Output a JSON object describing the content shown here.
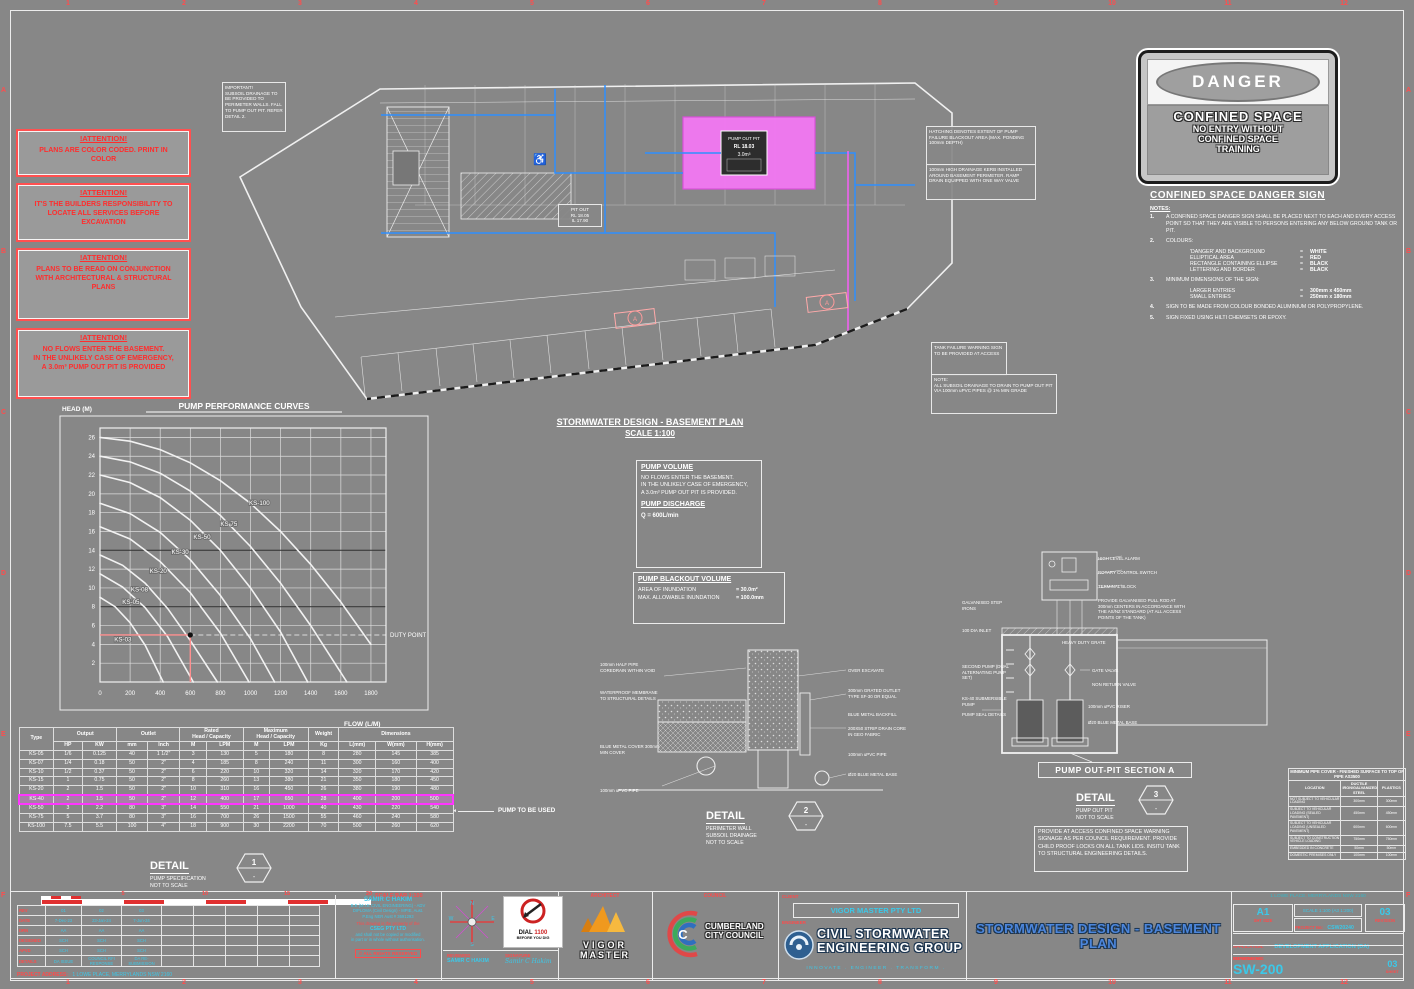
{
  "margin": {
    "cols": [
      "1",
      "2",
      "3",
      "4",
      "5",
      "6",
      "7",
      "8",
      "9",
      "10",
      "11",
      "12"
    ],
    "rows": [
      "A",
      "B",
      "C",
      "D",
      "E",
      "F"
    ]
  },
  "attention": [
    {
      "title": "!ATTENTION!",
      "body": "PLANS ARE COLOR CODED. PRINT IN\nCOLOR"
    },
    {
      "title": "!ATTENTION!",
      "body": "IT'S THE BUILDERS RESPONSIBILITY TO\nLOCATE ALL SERVICES BEFORE\nEXCAVATION"
    },
    {
      "title": "!ATTENTION!",
      "body": "PLANS TO BE READ ON CONJUNCTION\nWITH ARCHITECTURAL & STRUCTURAL\nPLANS"
    },
    {
      "title": "!ATTENTION!",
      "body": "NO FLOWS ENTER THE BASEMENT.\nIN THE UNLIKELY CASE OF EMERGENCY,\nA 3.0m³ PUMP OUT PIT IS PROVIDED"
    }
  ],
  "plan": {
    "title": "STORMWATER DESIGN - BASEMENT PLAN",
    "scale": "SCALE 1:100",
    "pit_l1": "PUMP OUT PIT",
    "pit_l2": "RL 18.03",
    "pit_l3": "3.0m³",
    "pit_out": "PIT OUT\nRL 18.05\nIL 17.90",
    "section_marker": "A",
    "notes": [
      "IMPORTANT!\nSUBSOIL DRAINAGE TO BE PROVIDED TO PERIMETER WALLS. FALL TO PUMP OUT PIT. REFER DETAIL 2.",
      "HATCHING DENOTES EXTENT OF PUMP FAILURE BLACKOUT AREA (MAX. PONDING 100mm DEPTH)",
      "100mm HIGH DRAINAGE KERB INSTALLED AROUND BASEMENT PERIMETER. RAMP DRAIN EQUIPPED WITH ONE WAY VALVE",
      "TANK FAILURE WARNING SIGN TO BE PROVIDED AT ACCESS",
      "NOTE:\nALL SUBSOIL DRAINAGE TO DRAIN TO PUMP OUT PIT VIA 100mm uPVC PIPES @ 1% MIN GRADE"
    ]
  },
  "danger_sign": {
    "word": "DANGER",
    "line1": "CONFINED SPACE",
    "line2": "NO ENTRY WITHOUT",
    "line3": "CONFINED SPACE",
    "line4": "TRAINING"
  },
  "confined": {
    "heading": "CONFINED SPACE DANGER SIGN",
    "notes_label": "NOTES:",
    "items": [
      {
        "n": "1.",
        "text": "A CONFINED SPACE DANGER SIGN SHALL BE PLACED NEXT TO EACH AND EVERY ACCESS POINT SO THAT THEY ARE VISIBLE TO PERSONS ENTERING ANY BELOW GROUND TANK OR PIT."
      },
      {
        "n": "2.",
        "text": "COLOURS:",
        "pairs": [
          [
            "'DANGER' AND BACKGROUND",
            "WHITE"
          ],
          [
            "ELLIPTICAL AREA",
            "RED"
          ],
          [
            "RECTANGLE CONTAINING ELLIPSE",
            "BLACK"
          ],
          [
            "LETTERING AND BORDER",
            "BLACK"
          ]
        ]
      },
      {
        "n": "3.",
        "text": "MINIMUM DIMENSIONS OF THE SIGN:",
        "pairs": [
          [
            "LARGER ENTRIES",
            "300mm x 450mm"
          ],
          [
            "SMALL ENTRIES",
            "250mm x 180mm"
          ]
        ]
      },
      {
        "n": "4.",
        "text": "SIGN TO BE MADE FROM COLOUR BONDED ALUMINIUM OR POLYPROPYLENE."
      },
      {
        "n": "5.",
        "text": "SIGN FIXED USING HILTI CHEMSETS OR EPOXY."
      }
    ]
  },
  "chart_data": {
    "type": "line",
    "title": "PUMP PERFORMANCE CURVES",
    "xlabel": "FLOW (L/M)",
    "ylabel": "HEAD (M)",
    "xlim": [
      0,
      1900
    ],
    "ylim": [
      0,
      27
    ],
    "xticks": [
      0,
      200,
      400,
      600,
      800,
      1000,
      1200,
      1400,
      1600,
      1800
    ],
    "yticks": [
      2,
      4,
      6,
      8,
      10,
      12,
      14,
      16,
      18,
      20,
      22,
      24,
      26
    ],
    "dark_gridlines_y": [
      8,
      14
    ],
    "series": [
      {
        "name": "KS-100",
        "label_at": [
          990,
          18.8
        ],
        "points": [
          [
            0,
            26
          ],
          [
            200,
            25.6
          ],
          [
            400,
            24.7
          ],
          [
            600,
            23.3
          ],
          [
            800,
            21.4
          ],
          [
            1000,
            19
          ],
          [
            1200,
            16
          ],
          [
            1400,
            12.5
          ],
          [
            1600,
            8.5
          ],
          [
            1800,
            4
          ]
        ]
      },
      {
        "name": "KS 75",
        "label_at": [
          800,
          16.6
        ],
        "points": [
          [
            0,
            24
          ],
          [
            200,
            23.4
          ],
          [
            400,
            22.2
          ],
          [
            600,
            20.3
          ],
          [
            800,
            17.7
          ],
          [
            1000,
            14.4
          ],
          [
            1200,
            10.5
          ],
          [
            1400,
            6
          ],
          [
            1600,
            1
          ],
          [
            1640,
            0
          ]
        ]
      },
      {
        "name": "KS-50",
        "label_at": [
          620,
          15.2
        ],
        "points": [
          [
            0,
            22
          ],
          [
            200,
            21.2
          ],
          [
            400,
            19.6
          ],
          [
            600,
            17.2
          ],
          [
            800,
            14
          ],
          [
            1000,
            10
          ],
          [
            1200,
            5.3
          ],
          [
            1380,
            0
          ]
        ]
      },
      {
        "name": "KS-30",
        "label_at": [
          475,
          13.6
        ],
        "points": [
          [
            0,
            19
          ],
          [
            200,
            17.9
          ],
          [
            400,
            15.9
          ],
          [
            600,
            13
          ],
          [
            800,
            9.2
          ],
          [
            1000,
            4.6
          ],
          [
            1160,
            0
          ]
        ]
      },
      {
        "name": "KS-20",
        "label_at": [
          330,
          11.6
        ],
        "points": [
          [
            0,
            16.5
          ],
          [
            200,
            15.2
          ],
          [
            400,
            12.8
          ],
          [
            600,
            9.5
          ],
          [
            800,
            5.2
          ],
          [
            990,
            0
          ]
        ]
      },
      {
        "name": "KS-08",
        "label_at": [
          205,
          9.6
        ],
        "points": [
          [
            0,
            13.5
          ],
          [
            150,
            12.4
          ],
          [
            300,
            10.5
          ],
          [
            450,
            7.8
          ],
          [
            600,
            4.4
          ],
          [
            780,
            0
          ]
        ]
      },
      {
        "name": "KS-05",
        "label_at": [
          148,
          8.3
        ],
        "points": [
          [
            0,
            11.5
          ],
          [
            150,
            10.1
          ],
          [
            300,
            7.9
          ],
          [
            450,
            4.8
          ],
          [
            620,
            0
          ]
        ]
      },
      {
        "name": "KS-03",
        "label_at": [
          95,
          4.3
        ],
        "points": [
          [
            0,
            9
          ],
          [
            100,
            8
          ],
          [
            200,
            6.3
          ],
          [
            300,
            3.9
          ],
          [
            420,
            0
          ]
        ]
      }
    ],
    "duty_point": {
      "x": 600,
      "y": 5,
      "label": "DUTY POINT"
    },
    "legend_position": "on-curve",
    "grid": true
  },
  "pump_table": {
    "h_type": "Type",
    "h_output": "Output",
    "h_outlet": "Outlet",
    "h_rated": "Rated\nHead / Capacity",
    "h_max": "Maximum\nHead / Capacity",
    "h_weight": "Weight",
    "h_dims": "Dimensions",
    "sub": [
      "HP",
      "KW",
      "mm",
      "Inch",
      "M",
      "LPM",
      "M",
      "LPM",
      "Kg",
      "L(mm)",
      "W(mm)",
      "H(mm)"
    ],
    "rows": [
      [
        "KS-05",
        "1/6",
        "0.125",
        "40",
        "1 1/2\"",
        "3",
        "130",
        "5",
        "180",
        "8",
        "280",
        "145",
        "385"
      ],
      [
        "KS-07",
        "1/4",
        "0.18",
        "50",
        "2\"",
        "4",
        "185",
        "8",
        "240",
        "11",
        "300",
        "160",
        "400"
      ],
      [
        "KS-10",
        "1/2",
        "0.37",
        "50",
        "2\"",
        "6",
        "220",
        "10",
        "320",
        "14",
        "320",
        "170",
        "420"
      ],
      [
        "KS-15",
        "1",
        "0.75",
        "50",
        "2\"",
        "8",
        "260",
        "13",
        "380",
        "21",
        "350",
        "180",
        "450"
      ],
      [
        "KS-20",
        "2",
        "1.5",
        "50",
        "2\"",
        "10",
        "310",
        "16",
        "450",
        "26",
        "380",
        "190",
        "480"
      ],
      [
        "KS-40",
        "2",
        "1.5",
        "50",
        "2\"",
        "12",
        "400",
        "17",
        "650",
        "28",
        "400",
        "200",
        "500"
      ],
      [
        "KS-50",
        "3",
        "2.2",
        "80",
        "3\"",
        "14",
        "550",
        "21",
        "1000",
        "40",
        "430",
        "220",
        "540"
      ],
      [
        "KS-75",
        "5",
        "3.7",
        "80",
        "3\"",
        "16",
        "700",
        "26",
        "1500",
        "55",
        "460",
        "240",
        "580"
      ],
      [
        "KS-100",
        "7.5",
        "5.5",
        "100",
        "4\"",
        "18",
        "900",
        "30",
        "2200",
        "70",
        "500",
        "260",
        "620"
      ]
    ],
    "highlight_row": 5,
    "callout": "PUMP TO BE USED"
  },
  "detail1": {
    "title": "DETAIL",
    "sub": "PUMP SPECIFICATION\nNOT TO SCALE",
    "num": "1",
    "dash": "-"
  },
  "pump_volume": {
    "heading": "PUMP VOLUME",
    "body": "NO FLOWS ENTER THE BASEMENT.\nIN THE UNLIKELY CASE OF EMERGENCY,\nA 3.0m³ PUMP OUT PIT IS PROVIDED.",
    "discharge_heading": "PUMP DISCHARGE",
    "discharge_value": "Q = 600L/min"
  },
  "pump_blackout": {
    "heading": "PUMP BLACKOUT VOLUME",
    "rows": [
      [
        "AREA OF INUNDATION",
        "= 30.0m²"
      ],
      [
        "MAX. ALLOWABLE INUNDATION",
        "= 100.0mm"
      ]
    ]
  },
  "detail2": {
    "title": "DETAIL",
    "sub": "PERIMETER WALL\nSUBSOIL DRAINAGE\nNOT TO SCALE",
    "num": "2",
    "dash": "-",
    "left_labels": [
      "100mm HALF PIPE COREDRAIN WITHIN VOID",
      "WATERPROOF MEMBRANE TO STRUCTURAL DETAILS",
      "BLUE METAL COVER 300mm MIN COVER",
      "100mm uPVC PIPE"
    ],
    "right_labels": [
      "OVER EXCAVATE",
      "300mm GRATED OUTLET TYPE SF-30 OR EQUAL",
      "BLUE METAL BACKFILL",
      "200X50 STRIP DRAIN CORE IN GEO FABRIC",
      "100mm uPVC PIPE",
      "Ø20 BLUE METAL BASE"
    ]
  },
  "section_a": {
    "heading": "PUMP OUT-PIT SECTION A",
    "detail_title": "DETAIL",
    "detail_sub": "PUMP OUT PIT\nNOT TO SCALE",
    "num": "3",
    "dash": "-",
    "right_labels": [
      "HIGH LEVEL ALARM",
      "ROTARY CONTROL SWITCH",
      "TERMINAL BLOCK",
      "PROVIDE GALVANISED PULL ROD AT 300mm CENTERS IN ACCORDANCE WITH THE AS/NZ STANDARD (AT ALL ACCESS POINTS OF THE TANK)",
      "HEAVY DUTY GRATE",
      "GATE VALVE",
      "NON RETURN VALVE",
      "100mm uPVC RISER",
      "Ø20 BLUE METAL BASE"
    ],
    "left_labels": [
      "GALVANISED STEP IRONS",
      "100 DIA INLET",
      "SECOND PUMP (DUAL ALTERNATING PUMP SET)",
      "KS-40 SUBMERSIBLE PUMP",
      "PUMP SEAL DETAILS"
    ],
    "note": "PROVIDE AT ACCESS CONFINED SPACE WARNING SIGNAGE AS PER COUNCIL REQUIREMENT. PROVIDE CHILD PROOF LOCKS ON ALL TANK LIDS. INSITU TANK TO STRUCTURAL ENGINEERING DETAILS."
  },
  "pipe_cover": {
    "title": "MINIMUM PIPE COVER - FINISHED SURFACE TO TOP OF PIPE AS3500",
    "headers": [
      "LOCATION",
      "DUCTILE IRON/GALVANIZED STEEL",
      "PLASTICS"
    ],
    "rows": [
      [
        "NOT SUBJECT TO VEHICULAR LOADING",
        "300mm",
        "300mm"
      ],
      [
        "SUBJECT TO VEHICULAR LOADING (SEALED PAVEMENT)",
        "450mm",
        "450mm"
      ],
      [
        "SUBJECT TO VEHICULAR LOADING (UNSEALED PAVEMENT)",
        "600mm",
        "600mm"
      ],
      [
        "SUBJECT TO CONSTRUCTION VEHICLE LOADING",
        "750mm",
        "750mm"
      ],
      [
        "EMBEDDED IN CONCRETE",
        "50mm",
        "50mm"
      ],
      [
        "DOMESTIC PREMISES ONLY",
        "100mm",
        "100mm"
      ]
    ]
  },
  "titleblock": {
    "labels": {
      "architect": "ARCHITECT",
      "council": "COUNCIL",
      "client": "CLIENT",
      "engineer": "ENGINEER",
      "application": "APPLICATION:",
      "supersedes": "SUPERSEDES:",
      "drawing_no": "DRAWING No:",
      "project_no": "PROJECT No:",
      "sht_size": "SHT SIZE",
      "revision": "REVISION",
      "sheet": "SHEET",
      "reviewed": "REVIEWED",
      "signature": "SIGNATURE",
      "project_address": "PROJECT ADDRESS:",
      "scalebar_caption": "SCALE BAR 1:100"
    },
    "values": {
      "sht_size": "A1",
      "scale": "SCALE 1:100 (A3 1:200)",
      "project_no": "CSW20240",
      "revision": "03",
      "application": "DEVELOPMENT APPLICATION (DA)",
      "drawing_no": "SW-200",
      "sheet": "03",
      "title": "STORMWATER DESIGN - BASEMENT PLAN",
      "client": "VIGOR MASTER PTY LTD",
      "address": "1 LOWE PLACE, MERRYLANDS NSW 2160",
      "reviewed_by": "SAMIR C HAKIM",
      "signature_script": "Samir C Hakim"
    },
    "engineer_logo": {
      "line1": "CIVIL STORMWATER",
      "line2": "ENGINEERING GROUP",
      "tagline": "INNOVATE . ENGINEER . TRANSFORM ."
    },
    "council_logo": {
      "line1": "CUMBERLAND",
      "line2": "CITY COUNCIL"
    },
    "architect_logo": {
      "line1": "VIGOR",
      "line2": "MASTER"
    },
    "dial": {
      "word": "DIAL",
      "number": "1100",
      "sub": "BEFORE YOU DIG"
    },
    "credentials": {
      "name": "SAMIR C HAKIM",
      "quals": "B.E (M.I.E CIVIL ENGINEERING) - ADV\nDIPLOMA (Civil Design) - MPIE, Aust.\nP.Eng NER Aust # 3691293",
      "property1": "This drawing is the property of the",
      "firm": "CSEG PTY LTD",
      "property2": "and shall not be copied or modified\nin part or in whole without authorisation.",
      "rights": "© ALL RIGHTS RESERVED"
    },
    "revisions": {
      "row_labels": [
        "REV",
        "DATE",
        "DRN",
        "DESIGNED",
        "APVD",
        "DETAILS"
      ],
      "columns": [
        [
          "01",
          "7-Dec-23",
          "AA",
          "SCH",
          "SCH",
          "DA ISSUE"
        ],
        [
          "02",
          "23-Jan-24",
          "AA",
          "SCH",
          "SCH",
          "COUNCIL RFI RESPONSE"
        ],
        [
          "03",
          "7-Jun-24",
          "AA",
          "SCH",
          "SCH",
          "DA RE-SUBMISSION"
        ]
      ],
      "empty_cols": 5
    },
    "scalebar": {
      "labels": [
        "5",
        "10",
        "15",
        "20"
      ]
    }
  },
  "compass": {
    "n": "N",
    "e": "E",
    "s": "S",
    "w": "W"
  },
  "colors": {
    "accent_red": "#ff4a4a",
    "cyan": "#3cc8e8",
    "title_blue": "#4c86dc",
    "blackout_pink": "#f277f2",
    "pipe_blue": "#2f8fff",
    "highlight_magenta": "#ff35ff"
  }
}
